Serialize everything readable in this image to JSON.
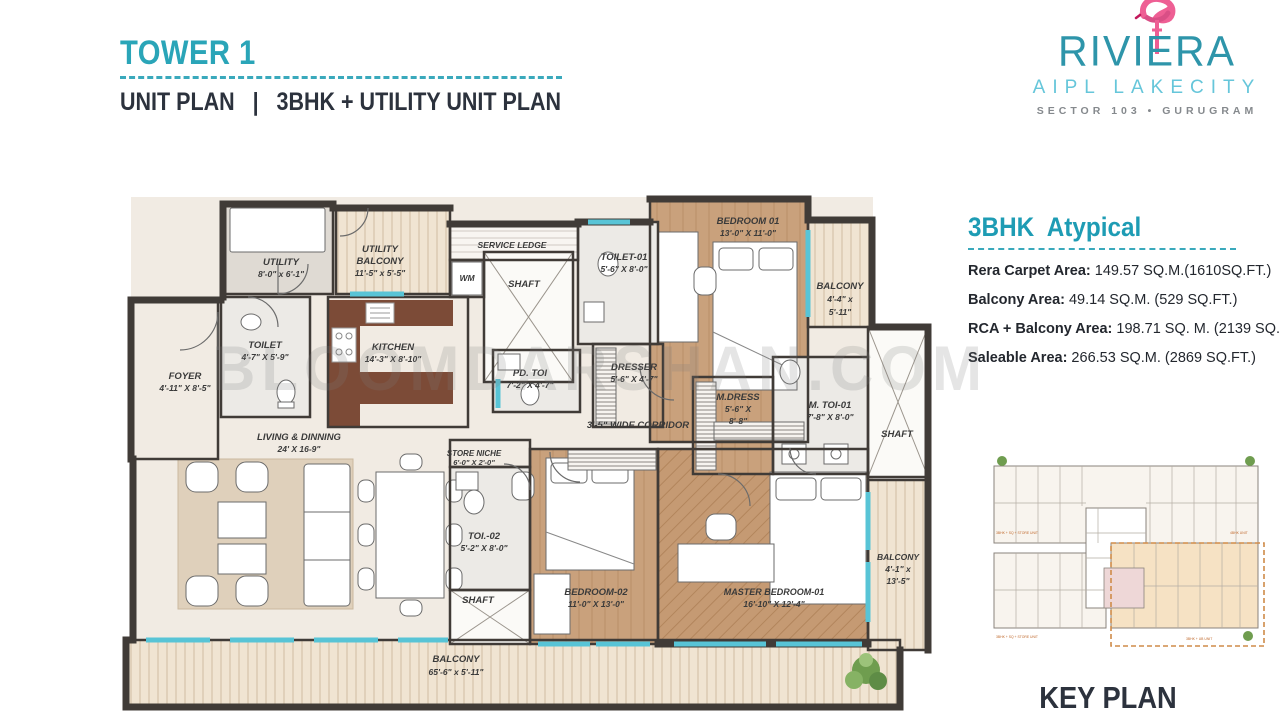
{
  "header": {
    "tower": "TOWER 1",
    "subtitle": "UNIT PLAN   |   3BHK + UTILITY UNIT PLAN"
  },
  "logo": {
    "name": "RIVIERA",
    "tagline": "AIPL LAKECITY",
    "location": "SECTOR 103 • GURUGRAM"
  },
  "unit_info": {
    "title": "3BHK  Atypical",
    "rera_label": "Rera Carpet Area:",
    "rera_value": " 149.57 SQ.M.(1610SQ.FT.)",
    "balcony_label": "Balcony Area:",
    "balcony_value": " 49.14 SQ.M. (529 SQ.FT.)",
    "rca_label": "RCA + Balcony Area:",
    "rca_value": " 198.71 SQ. M. (2139 SQ.FT.)",
    "saleable_label": "Saleable Area:",
    "saleable_value": " 266.53 SQ.M. (2869 SQ.FT.)"
  },
  "watermark": "BLOOMDARSHAN.COM",
  "key_plan": {
    "title": "KEY PLAN",
    "unit_labels": [
      "3BHK + SQ + STORE UNIT",
      "4BHK UNIT",
      "3BHK + SQ + STORE UNIT",
      "3BHK + UB UNIT"
    ]
  },
  "rooms": {
    "foyer": {
      "name": "FOYER",
      "dim": "4'-11\" X 8'-5\""
    },
    "utility": {
      "name": "UTILITY",
      "dim": "8'-0\" x 6'-1\""
    },
    "utility_balcony": {
      "name": "UTILITY",
      "name2": "BALCONY",
      "dim": "11'-5\" x 5'-5\""
    },
    "service_ledge": {
      "name": "SERVICE LEDGE"
    },
    "wm": {
      "name": "WM"
    },
    "shaft_top": {
      "name": "SHAFT"
    },
    "toilet": {
      "name": "TOILET",
      "dim": "4'-7\" X 5'-9\""
    },
    "kitchen": {
      "name": "KITCHEN",
      "dim": "14'-3\" X 8'-10\""
    },
    "pd_toi": {
      "name": "PD. TOI",
      "dim": "7'-2\" X 4'-7\""
    },
    "toilet_01": {
      "name": "TOILET-01",
      "dim": "5'-6\" X 8'-0\""
    },
    "dresser": {
      "name": "DRESSER",
      "dim": "5'-6\" X 4'-7\""
    },
    "bedroom_01": {
      "name": "BEDROOM 01",
      "dim": "13'-0\" X 11'-0\""
    },
    "balcony_b1": {
      "name": "BALCONY",
      "dim1": "4'-4\" x",
      "dim2": "5'-11\""
    },
    "m_dress": {
      "name": "M.DRESS",
      "dim1": "5'-6\" X",
      "dim2": "8'-8\""
    },
    "m_toi": {
      "name": "M. TOI-01",
      "dim": "7'-8\" X 8'-0\""
    },
    "shaft_right": {
      "name": "SHAFT"
    },
    "living": {
      "name": "LIVING & DINNING",
      "dim": "24' X 16-9\""
    },
    "corridor": {
      "name": "3'-5\" WIDE CORRIDOR"
    },
    "store_niche": {
      "name": "STORE NICHE",
      "dim": "6'-0\" X 2'-0\""
    },
    "toi_02": {
      "name": "TOI.-02",
      "dim": "5'-2\" X 8'-0\""
    },
    "shaft_bottom": {
      "name": "SHAFT"
    },
    "bedroom_02": {
      "name": "BEDROOM-02",
      "dim": "11'-0\" X 13'-0\""
    },
    "master_bedroom": {
      "name": "MASTER BEDROOM-01",
      "dim": "16'-10\" X 12'-4\""
    },
    "balcony_right": {
      "name": "BALCONY",
      "dim1": "4'-1\" x",
      "dim2": "13'-5\""
    },
    "balcony_bottom": {
      "name": "BALCONY",
      "dim": "65'-6\" x 5'-11\""
    }
  }
}
